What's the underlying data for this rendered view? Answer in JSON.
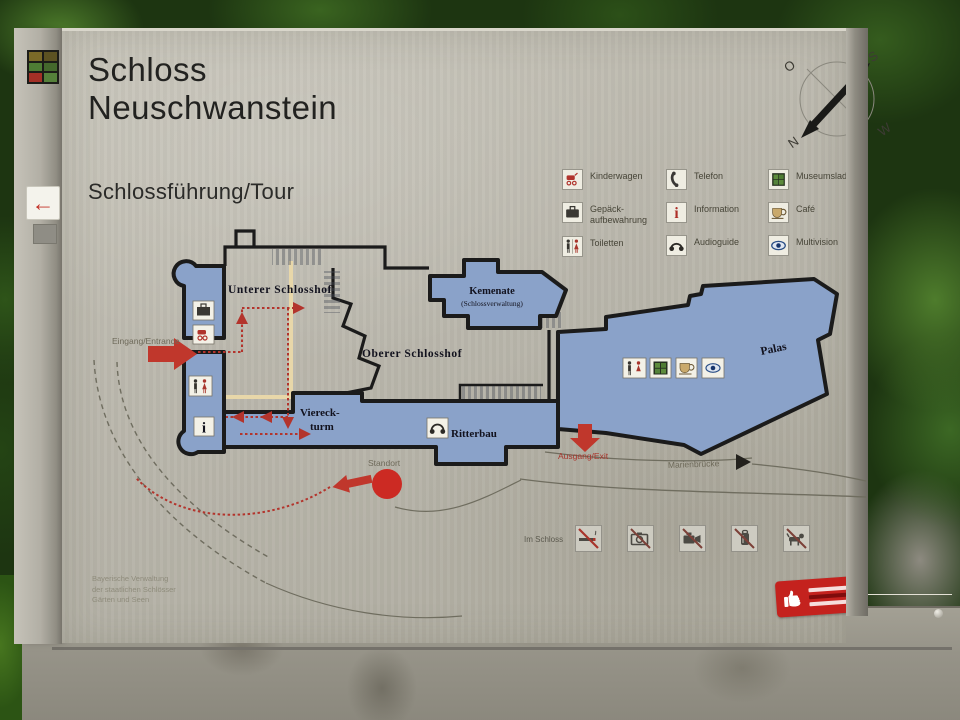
{
  "header": {
    "title_line1": "Schloss",
    "title_line2": "Neuschwanstein",
    "subtitle": "Schlossführung/Tour"
  },
  "compass": {
    "o": "O",
    "s": "S",
    "n": "N",
    "w": "W"
  },
  "legend": {
    "items": [
      {
        "icon": "stroller-icon",
        "label": "Kinderwagen"
      },
      {
        "icon": "luggage-icon",
        "label": "Gepäck-\naufbewahrung"
      },
      {
        "icon": "toilets-icon",
        "label": "Toiletten"
      },
      {
        "icon": "telephone-icon",
        "label": "Telefon"
      },
      {
        "icon": "information-icon",
        "label": "Information"
      },
      {
        "icon": "audioguide-icon",
        "label": "Audioguide"
      },
      {
        "icon": "museum-shop-icon",
        "label": "Museumsladen"
      },
      {
        "icon": "cafe-icon",
        "label": "Café"
      },
      {
        "icon": "multivision-icon",
        "label": "Multivision"
      }
    ]
  },
  "map": {
    "labels": {
      "unterer": "Unterer Schlosshof",
      "oberer": "Oberer Schlosshof",
      "kemenate": "Kemenate",
      "kemenate_sub": "(Schlossverwaltung)",
      "palas": "Palas",
      "viereck_1": "Viereck-",
      "viereck_2": "turm",
      "ritterbau": "Ritterbau",
      "eingang": "Eingang/Entrance",
      "ausgang": "Ausgang/Exit",
      "marienbruecke": "Marienbrücke",
      "standort": "Standort"
    },
    "colors": {
      "building_fill": "#8aa2c9",
      "outline": "#1b1b1b",
      "route_red": "#b3342c",
      "balustrade": "#e8d7a9"
    }
  },
  "prohibitions": {
    "heading": "Im Schloss",
    "icons": [
      "no-smoking-icon",
      "no-photography-icon",
      "no-filming-icon",
      "no-backpacks-icon",
      "no-dogs-icon"
    ]
  },
  "footer": {
    "credit": "Bayerische Verwaltung\nder staatlichen Schlösser\nGärten und Seen"
  }
}
